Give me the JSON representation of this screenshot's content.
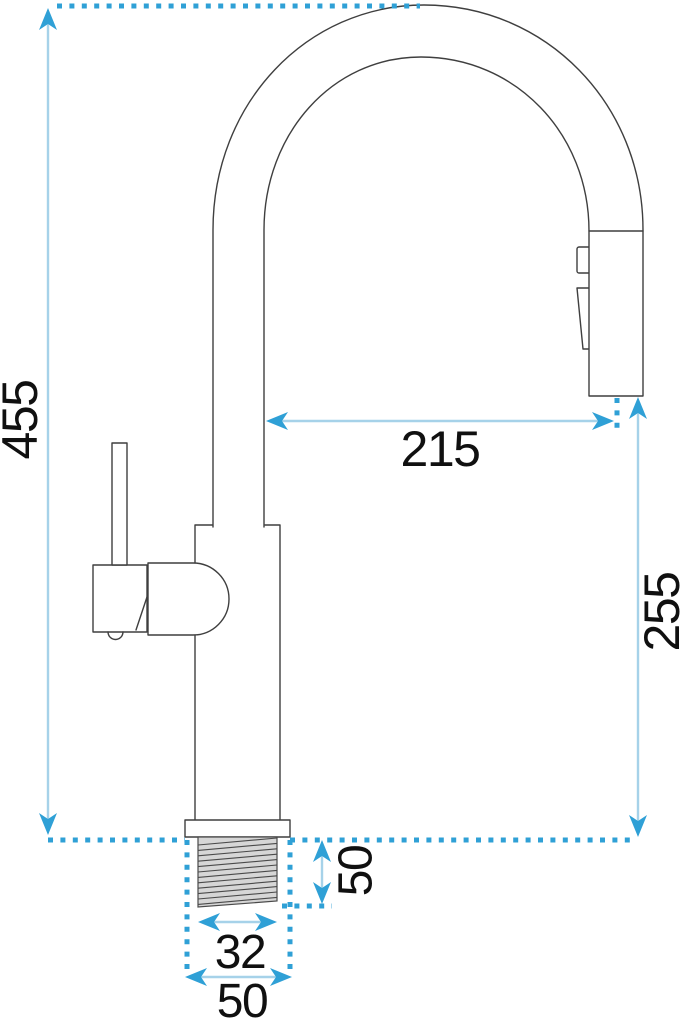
{
  "diagram": {
    "title": "Kitchen faucet technical dimension drawing (side view)",
    "type": "technical-dimension-drawing",
    "subject": "pull-out kitchen mixer tap",
    "labels": {
      "total_height": "455",
      "spout_reach": "215",
      "outlet_height": "255",
      "shank_length": "50",
      "thread_width": "32",
      "base_width": "50"
    },
    "colors": {
      "dimension_accent": "#2fa0d6",
      "dimension_line": "#a6d2e9",
      "outline": "#3f3f3f",
      "thread_fill": "#d6d6d6",
      "background": "#ffffff",
      "text": "#101010"
    }
  }
}
